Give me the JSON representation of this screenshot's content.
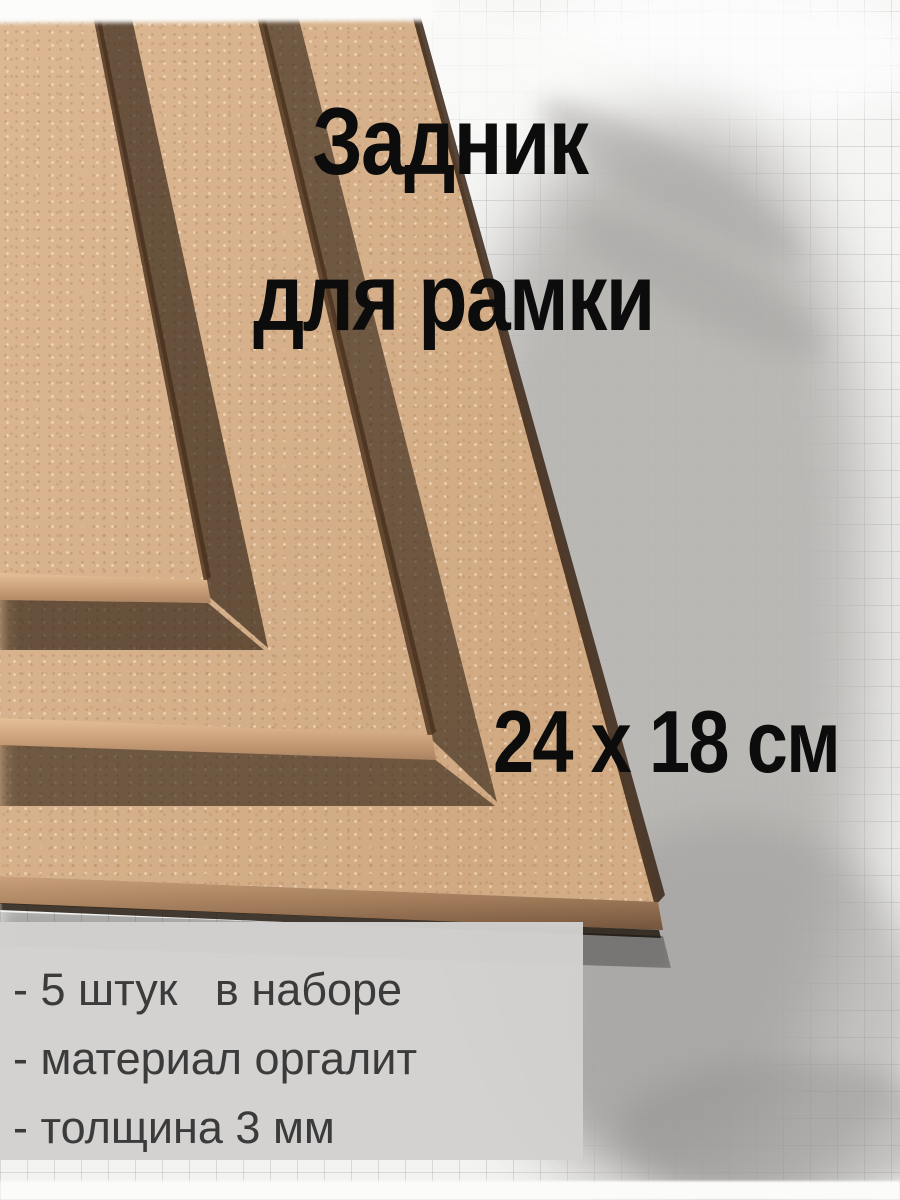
{
  "product": {
    "title_line1": "Задник",
    "title_line2": "для рамки",
    "size_label": "24 x 18 см",
    "features": [
      "- 5 штук   в наборе",
      "- материал оргалит",
      "- толщина 3 мм"
    ]
  },
  "style": {
    "board_color": "#d9b28a",
    "board_edge_color": "#a67d5c",
    "panel_color": "#d2d1cf",
    "title_color": "#0c0c0c",
    "feature_text_color": "#3b3b3b",
    "background_gray": "#b9b8b6",
    "grid_line_color": "#787878"
  }
}
